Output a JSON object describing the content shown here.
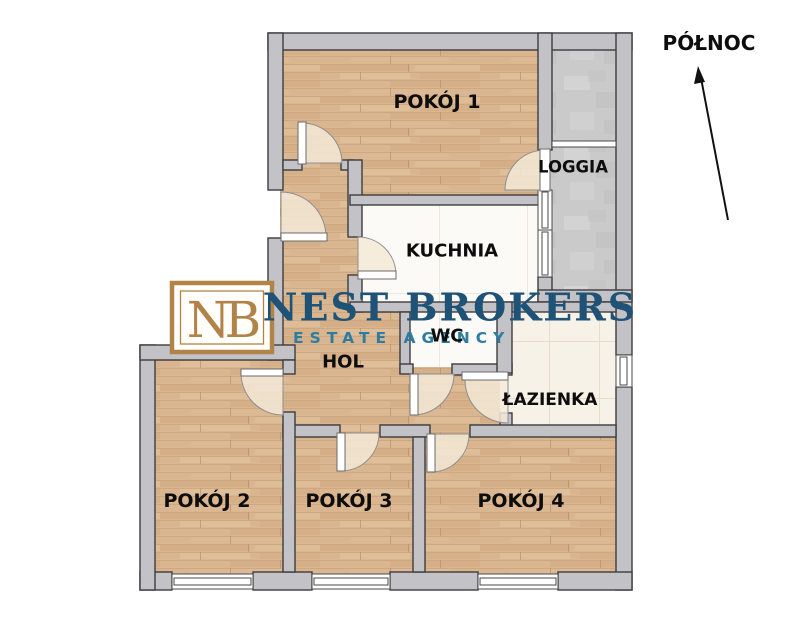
{
  "plan": {
    "compass_label": "PÓŁNOC",
    "rooms": {
      "pokoj1": {
        "label": "POKÓJ 1"
      },
      "loggia": {
        "label": "LOGGIA"
      },
      "kuchnia": {
        "label": "KUCHNIA"
      },
      "wc": {
        "label": "WC"
      },
      "hol": {
        "label": "HOL"
      },
      "lazienka": {
        "label": "ŁAZIENKA"
      },
      "pokoj2": {
        "label": "POKÓJ 2"
      },
      "pokoj3": {
        "label": "POKÓJ 3"
      },
      "pokoj4": {
        "label": "POKÓJ 4"
      }
    }
  },
  "watermark": {
    "monogram": "NB",
    "monogram_color": "#b28348",
    "name": "NEST BROKERS",
    "name_color": "#1e5276",
    "tagline": "ESTATE AGENCY",
    "tagline_color": "#2e7ca2"
  },
  "colors": {
    "wood_floor": "#d9b590",
    "loggia_floor": "#cacaca",
    "bath_floor": "#f7f2e7",
    "kitchen_floor": "#fbfaf6",
    "wall_fill": "#c3c3c7",
    "wall_outline": "#3d3d3f",
    "label_text": "#0d0d0d",
    "door_arc_fill": "#f3e9d7"
  }
}
